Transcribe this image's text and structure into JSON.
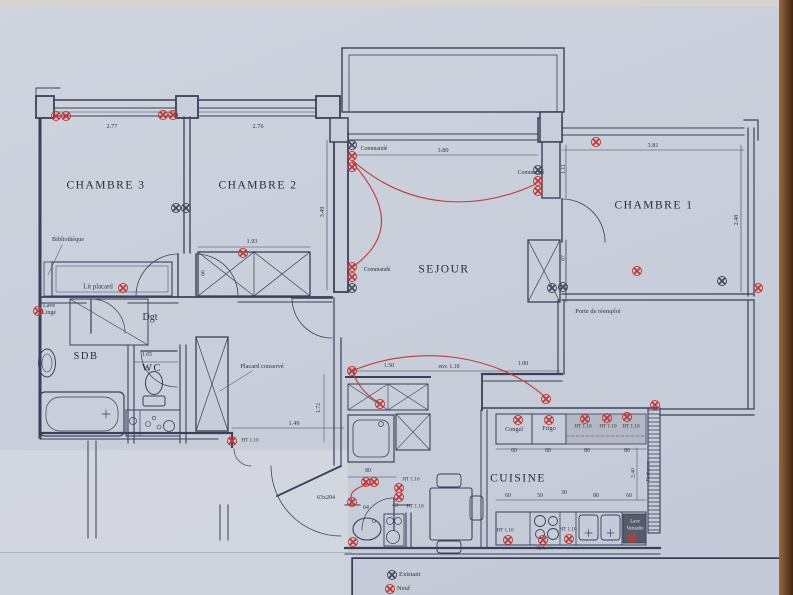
{
  "colors": {
    "paper": "#c9cfda",
    "ink": "#3a4059",
    "new": "#bf3a36",
    "existing": "#454a5e",
    "worktop": "#b4b8c4",
    "appliance_dark": "#565b68"
  },
  "texts": [
    {
      "name": "room-label-chambre3",
      "t": "CHAMBRE 3",
      "x": 106,
      "y": 186,
      "s": 11.5,
      "big": 1
    },
    {
      "name": "room-label-chambre2",
      "t": "CHAMBRE 2",
      "x": 258,
      "y": 186,
      "s": 11.5,
      "big": 1
    },
    {
      "name": "room-label-chambre1",
      "t": "CHAMBRE 1",
      "x": 654,
      "y": 206,
      "s": 11.5,
      "big": 1
    },
    {
      "name": "room-label-sejour",
      "t": "SEJOUR",
      "x": 444,
      "y": 270,
      "s": 11.5,
      "big": 1
    },
    {
      "name": "room-label-cuisine",
      "t": "CUISINE",
      "x": 518,
      "y": 479,
      "s": 11.5,
      "big": 1
    },
    {
      "name": "room-label-sdb",
      "t": "SDB",
      "x": 86,
      "y": 357,
      "s": 10.5,
      "big": 1
    },
    {
      "name": "room-label-wc",
      "t": "WC",
      "x": 152,
      "y": 369,
      "s": 10.5,
      "big": 1
    },
    {
      "name": "room-label-dgt",
      "t": "Dgt",
      "x": 150,
      "y": 318,
      "s": 10
    },
    {
      "name": "annotation-bibliotheque",
      "t": "Bibliothèque",
      "x": 68,
      "y": 240,
      "s": 6.2
    },
    {
      "name": "annotation-lit-placard",
      "t": "Lit placard",
      "x": 98,
      "y": 288,
      "s": 6.8
    },
    {
      "name": "annotation-lave",
      "t": "Lave",
      "x": 49,
      "y": 306,
      "s": 6
    },
    {
      "name": "annotation-linge",
      "t": "Linge",
      "x": 49,
      "y": 313,
      "s": 6
    },
    {
      "name": "annotation-placard-conserve",
      "t": "Placard conservé",
      "x": 262,
      "y": 367,
      "s": 6.4
    },
    {
      "name": "annotation-porte-reemploi",
      "t": "Porte de réemploi",
      "x": 598,
      "y": 312,
      "s": 6.4
    },
    {
      "name": "annotation-commande-1",
      "t": "Commandé",
      "x": 374,
      "y": 150,
      "s": 5.8
    },
    {
      "name": "annotation-commande-2",
      "t": "Commandé",
      "x": 531,
      "y": 174,
      "s": 5.8
    },
    {
      "name": "annotation-commande-3",
      "t": "Commandé",
      "x": 377,
      "y": 271,
      "s": 5.8
    },
    {
      "name": "annotation-congel",
      "t": "Congel",
      "x": 514,
      "y": 430,
      "s": 6.2
    },
    {
      "name": "annotation-frigo",
      "t": "Frigo",
      "x": 549,
      "y": 429,
      "s": 6.2
    },
    {
      "name": "annotation-lave-vaisselle-1",
      "t": "Lave",
      "x": 635,
      "y": 523,
      "s": 4.8,
      "c": "#e8e9ee"
    },
    {
      "name": "annotation-lave-vaisselle-2",
      "t": "Vaisselle",
      "x": 635,
      "y": 530,
      "s": 4.8,
      "c": "#e8e9ee"
    },
    {
      "name": "annotation-radiateur",
      "t": "Radiateur",
      "x": 649,
      "y": 471,
      "s": 5.2,
      "r": 1
    },
    {
      "name": "annotation-ht110-1",
      "t": "HT 1.10",
      "x": 250,
      "y": 441,
      "s": 5.2
    },
    {
      "name": "annotation-ht110-2",
      "t": "HT 1.10",
      "x": 583,
      "y": 427,
      "s": 5.2
    },
    {
      "name": "annotation-ht110-3",
      "t": "HT 1.10",
      "x": 608,
      "y": 427,
      "s": 5.2
    },
    {
      "name": "annotation-ht110-4",
      "t": "HT 1.10",
      "x": 631,
      "y": 427,
      "s": 5.2
    },
    {
      "name": "annotation-ht110-5",
      "t": "HT 1.10",
      "x": 505,
      "y": 531,
      "s": 5.2
    },
    {
      "name": "annotation-ht110-6",
      "t": "HT 1.10",
      "x": 568,
      "y": 530,
      "s": 5.2
    },
    {
      "name": "annotation-ht110-7",
      "t": "HT 1.10",
      "x": 411,
      "y": 480,
      "s": 5.2
    },
    {
      "name": "annotation-ht110-8",
      "t": "HT 1.10",
      "x": 415,
      "y": 507,
      "s": 5.2
    },
    {
      "name": "annotation-amperage",
      "t": "32A",
      "x": 541,
      "y": 549,
      "s": 5.5
    },
    {
      "name": "annotation-door-size",
      "t": "63x204",
      "x": 326,
      "y": 498,
      "s": 6
    },
    {
      "name": "dim-277",
      "t": "2.77",
      "x": 112,
      "y": 127,
      "s": 6.3
    },
    {
      "name": "dim-276",
      "t": "2.76",
      "x": 258,
      "y": 127,
      "s": 6.3
    },
    {
      "name": "dim-380",
      "t": "3.80",
      "x": 443,
      "y": 151,
      "s": 6.3
    },
    {
      "name": "dim-381",
      "t": "3.81",
      "x": 653,
      "y": 146,
      "s": 6.3
    },
    {
      "name": "dim-193",
      "t": "1.93",
      "x": 252,
      "y": 242,
      "s": 6.3
    },
    {
      "name": "dim-105",
      "t": "1.05",
      "x": 147,
      "y": 356,
      "s": 5.8
    },
    {
      "name": "dim-149",
      "t": "1.49",
      "x": 294,
      "y": 424,
      "s": 6.3
    },
    {
      "name": "dim-80a",
      "t": "80",
      "x": 368,
      "y": 472,
      "s": 5.8
    },
    {
      "name": "dim-150",
      "t": "1.50",
      "x": 389,
      "y": 367,
      "s": 5.8
    },
    {
      "name": "dim-env110",
      "t": "env. 1.10",
      "x": 449,
      "y": 368,
      "s": 5.8
    },
    {
      "name": "dim-100",
      "t": "1.00",
      "x": 523,
      "y": 365,
      "s": 5.8
    },
    {
      "name": "dim-60a",
      "t": "60",
      "x": 514,
      "y": 452,
      "s": 5.8
    },
    {
      "name": "dim-60b",
      "t": "60",
      "x": 548,
      "y": 452,
      "s": 5.8
    },
    {
      "name": "dim-80b",
      "t": "80",
      "x": 587,
      "y": 452,
      "s": 5.8
    },
    {
      "name": "dim-80c",
      "t": "80",
      "x": 627,
      "y": 452,
      "s": 5.8
    },
    {
      "name": "dim-60c",
      "t": "60",
      "x": 508,
      "y": 497,
      "s": 5.8
    },
    {
      "name": "dim-50",
      "t": "50",
      "x": 540,
      "y": 497,
      "s": 5.8
    },
    {
      "name": "dim-30",
      "t": "30",
      "x": 564,
      "y": 494,
      "s": 5.8
    },
    {
      "name": "dim-80d",
      "t": "80",
      "x": 596,
      "y": 497,
      "s": 5.8
    },
    {
      "name": "dim-60d",
      "t": "60",
      "x": 629,
      "y": 497,
      "s": 5.8
    },
    {
      "name": "dim-64",
      "t": "64",
      "x": 366,
      "y": 509,
      "s": 5.8
    },
    {
      "name": "dim-40",
      "t": "40",
      "x": 395,
      "y": 507,
      "s": 5.8
    },
    {
      "name": "dim-111",
      "t": "1.11",
      "x": 565,
      "y": 169,
      "s": 5.8,
      "r": 1
    },
    {
      "name": "dim-349",
      "t": "3.49",
      "x": 323,
      "y": 212,
      "s": 6,
      "r": 1
    },
    {
      "name": "dim-60e",
      "t": "60",
      "x": 204,
      "y": 273,
      "s": 5.5,
      "r": 1
    },
    {
      "name": "dim-67",
      "t": "67",
      "x": 564,
      "y": 258,
      "s": 5.5,
      "r": 1
    },
    {
      "name": "dim-248",
      "t": "2.48",
      "x": 737,
      "y": 220,
      "s": 6,
      "r": 1
    },
    {
      "name": "dim-172",
      "t": "1.72",
      "x": 320,
      "y": 408,
      "s": 5.8,
      "r": 1
    },
    {
      "name": "dim-240",
      "t": "2.40",
      "x": 634,
      "y": 473,
      "s": 5.5,
      "r": 1
    }
  ],
  "sockets": {
    "new": [
      [
        56,
        116
      ],
      [
        66,
        116
      ],
      [
        163,
        115
      ],
      [
        173,
        115
      ],
      [
        123,
        288
      ],
      [
        38,
        311
      ],
      [
        243,
        253
      ],
      [
        352,
        156
      ],
      [
        352,
        167
      ],
      [
        352,
        267
      ],
      [
        352,
        277
      ],
      [
        538,
        181
      ],
      [
        538,
        191
      ],
      [
        596,
        142
      ],
      [
        637,
        271
      ],
      [
        758,
        288
      ],
      [
        232,
        441
      ],
      [
        518,
        420
      ],
      [
        549,
        420
      ],
      [
        585,
        419
      ],
      [
        607,
        418
      ],
      [
        627,
        417
      ],
      [
        655,
        405
      ],
      [
        380,
        404
      ],
      [
        352,
        371
      ],
      [
        546,
        399
      ],
      [
        366,
        482
      ],
      [
        374,
        482
      ],
      [
        352,
        502
      ],
      [
        399,
        488
      ],
      [
        399,
        497
      ],
      [
        508,
        540
      ],
      [
        543,
        540
      ],
      [
        569,
        539
      ],
      [
        632,
        538
      ],
      [
        353,
        542
      ]
    ],
    "existing": [
      [
        176,
        208
      ],
      [
        186,
        208
      ],
      [
        352,
        145
      ],
      [
        352,
        288
      ],
      [
        552,
        288
      ],
      [
        563,
        287
      ],
      [
        722,
        281
      ],
      [
        538,
        170
      ]
    ]
  },
  "wires": [
    "M352,160 C410,212 480,210 536,184",
    "M352,162 C390,205 392,238 354,266",
    "M352,371 C420,342 500,356 545,397",
    "M353,373 C360,390 371,398 378,402",
    "M368,484 C352,489 349,495 352,500"
  ],
  "legend": {
    "items": [
      {
        "symbol": "existing",
        "label": "Existant"
      },
      {
        "symbol": "new",
        "label": "Neuf"
      }
    ]
  }
}
